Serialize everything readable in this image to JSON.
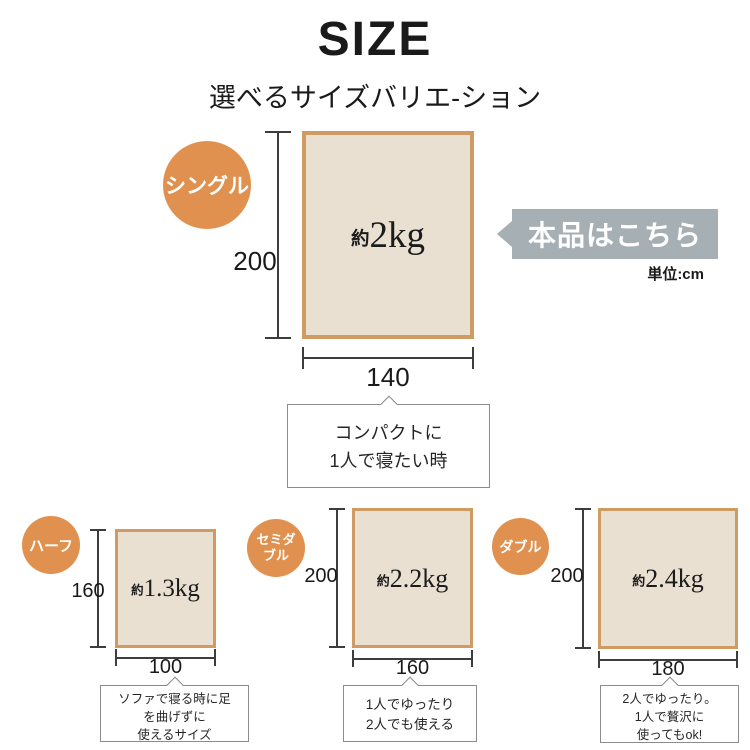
{
  "title": "SIZE",
  "subtitle": "選べるサイズバリエ-ション",
  "banner_label": "本品はこちら",
  "unit_label": "単位:cm",
  "colors": {
    "accent_orange": "#e0914f",
    "blanket_border": "#cf9b63",
    "blanket_fill": "#e9e0d1",
    "banner_gray": "#a6afb4"
  },
  "sizes": {
    "single": {
      "badge": "シングル",
      "weight_prefix": "約",
      "weight": "2kg",
      "height_cm": "200",
      "width_cm": "140",
      "note1": "コンパクトに",
      "note2": "1人で寝たい時"
    },
    "half": {
      "badge": "ハーフ",
      "weight_prefix": "約",
      "weight": "1.3kg",
      "height_cm": "160",
      "width_cm": "100",
      "note1": "ソファで寝る時に足",
      "note2": "を曲げずに",
      "note3": "使えるサイズ"
    },
    "semidouble": {
      "badge_line1": "セミダ",
      "badge_line2": "ブル",
      "weight_prefix": "約",
      "weight": "2.2kg",
      "height_cm": "200",
      "width_cm": "160",
      "note1": "1人でゆったり",
      "note2": "2人でも使える"
    },
    "double": {
      "badge": "ダブル",
      "weight_prefix": "約",
      "weight": "2.4kg",
      "height_cm": "200",
      "width_cm": "180",
      "note1": "2人でゆったり。",
      "note2": "1人で贅沢に",
      "note3": "使ってもok!"
    }
  }
}
